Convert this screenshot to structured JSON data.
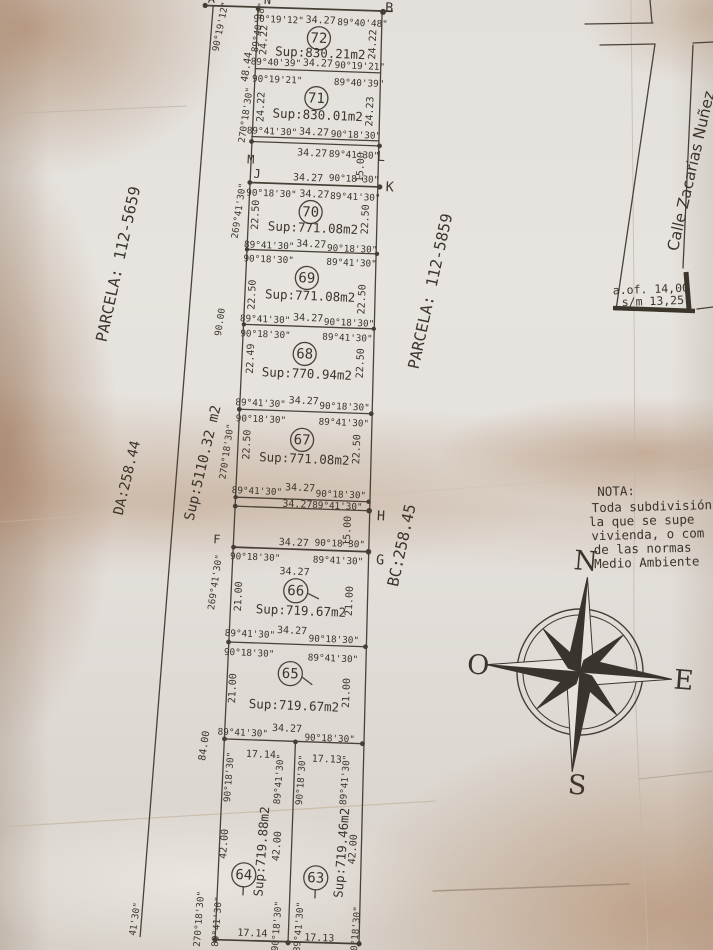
{
  "west_side": {
    "parcela": "PARCELA: 112-5659",
    "da_length": "DA:258.44",
    "total_area": "Sup:5110.32 m2",
    "angle_a": "90°19'12\"",
    "angle_n": "89°40'48\"",
    "dist_nm": "48.44",
    "angle_m": "270°18'30\"",
    "dist_90": "90.00",
    "dist_84": "84.00",
    "angle_bottom_partial": "41'30\""
  },
  "east_side": {
    "parcela": "PARCELA: 112-5859",
    "bc_length": "BC:258.45"
  },
  "points": {
    "a": "A",
    "n": "N",
    "b": "B",
    "m": "M",
    "l": "L",
    "j": "J",
    "k": "K",
    "h": "H",
    "f": "F",
    "g": "G"
  },
  "gaps": {
    "g1": "15.00",
    "g2": "15.00"
  },
  "street": {
    "name": "Calle Zacarias Nuñez",
    "official_width": "a.of. 14,00",
    "measured_width": "s/m 13,25"
  },
  "nota": {
    "heading": "NOTA:",
    "line1": "Toda subdivisión",
    "line2": "la que se supe",
    "line3": "vivienda, o com",
    "line4": "de las normas",
    "line5": "Medio Ambiente"
  },
  "compass": {
    "north": "N",
    "south": "S",
    "east": "E",
    "west": "O"
  },
  "lots": {
    "l72": {
      "num": "72",
      "sup": "Sup:830.21m2",
      "tl": "90°19'12\"",
      "tc": "34.27",
      "tr": "89°40'48\"",
      "bl": "89°40'39\"",
      "bc": "34.27",
      "br": "90°19'21\"",
      "sl": "24.22",
      "sr": "24.22"
    },
    "l71": {
      "num": "71",
      "sup": "Sup:830.01m2",
      "tl": "90°19'21\"",
      "tr": "89°40'39\"",
      "bl": "89°41'30\"",
      "bc": "34.27",
      "br": "90°18'30\"",
      "sl": "24.22",
      "sr": "24.23",
      "out_bc": "34.27",
      "out_br": "89°41'30\""
    },
    "l70": {
      "num": "70",
      "sup": "Sup:771.08m2",
      "out_tc": "34.27",
      "out_tr": "90°18'30\"",
      "tl": "90°18'30\"",
      "tc": "34.27",
      "tr": "89°41'30\"",
      "bl": "89°41'30\"",
      "bc": "34.27",
      "br": "90°18'30\"",
      "sl": "22.50",
      "sr": "22.50",
      "out_left": "269°41'30\""
    },
    "l69": {
      "num": "69",
      "sup": "Sup:771.08m2",
      "tl": "90°18'30\"",
      "tr": "89°41'30\"",
      "bl": "89°41'30\"",
      "bc": "34.27",
      "br": "90°18'30\"",
      "sl": "22.50",
      "sr": "22.50"
    },
    "l68": {
      "num": "68",
      "sup": "Sup:770.94m2",
      "tl": "90°18'30\"",
      "tr": "89°41'30\"",
      "bl": "89°41'30\"",
      "bc": "34.27",
      "br": "90°18'30\"",
      "sl": "22.49",
      "sr": "22.50"
    },
    "l67": {
      "num": "67",
      "sup": "Sup:771.08m2",
      "tl": "90°18'30\"",
      "tr": "89°41'30\"",
      "bl": "89°41'30\"",
      "bc": "34.27",
      "br": "90°18'30\"",
      "sl": "22.50",
      "sr": "22.50",
      "out_left": "270°18'30\"",
      "out_bc": "34.27",
      "out_br": "89°41'30\""
    },
    "l66": {
      "num": "66",
      "sup": "Sup:719.67m2",
      "out_tc": "34.27",
      "out_tr": "90°18'30\"",
      "tl": "90°18'30\"",
      "tc": "34.27",
      "tr": "89°41'30\"",
      "bl": "89°41'30\"",
      "bc": "34.27",
      "br": "90°18'30\"",
      "sl": "21.00",
      "sr": "21.00",
      "out_left": "269°41'30\""
    },
    "l65": {
      "num": "65",
      "sup": "Sup:719.67m2",
      "tl": "90°18'30\"",
      "tr": "89°41'30\"",
      "bl": "89°41'30\"",
      "bc": "34.27",
      "br": "90°18'30\"",
      "sl": "21.00",
      "sr": "21.00"
    },
    "l64": {
      "num": "64",
      "sup": "Sup:719.88m2",
      "top_len": "17.14",
      "bot_len": "17.14",
      "tl": "90°18'30\"",
      "tr": "89°41'30\"",
      "bl": "89°41'30\"",
      "br": "90°18'30\"",
      "sl": "42.00",
      "sr": "42.00",
      "out_bl": "270°18'30\""
    },
    "l63": {
      "num": "63",
      "sup": "Sup:719.46m2",
      "top_len": "17.13",
      "bot_len": "17.13",
      "tl": "90°18'30\"",
      "tr": "89°41'30\"",
      "bl": "89°41'30\"",
      "br": "90°18'30\"",
      "sr": "42.00"
    }
  }
}
